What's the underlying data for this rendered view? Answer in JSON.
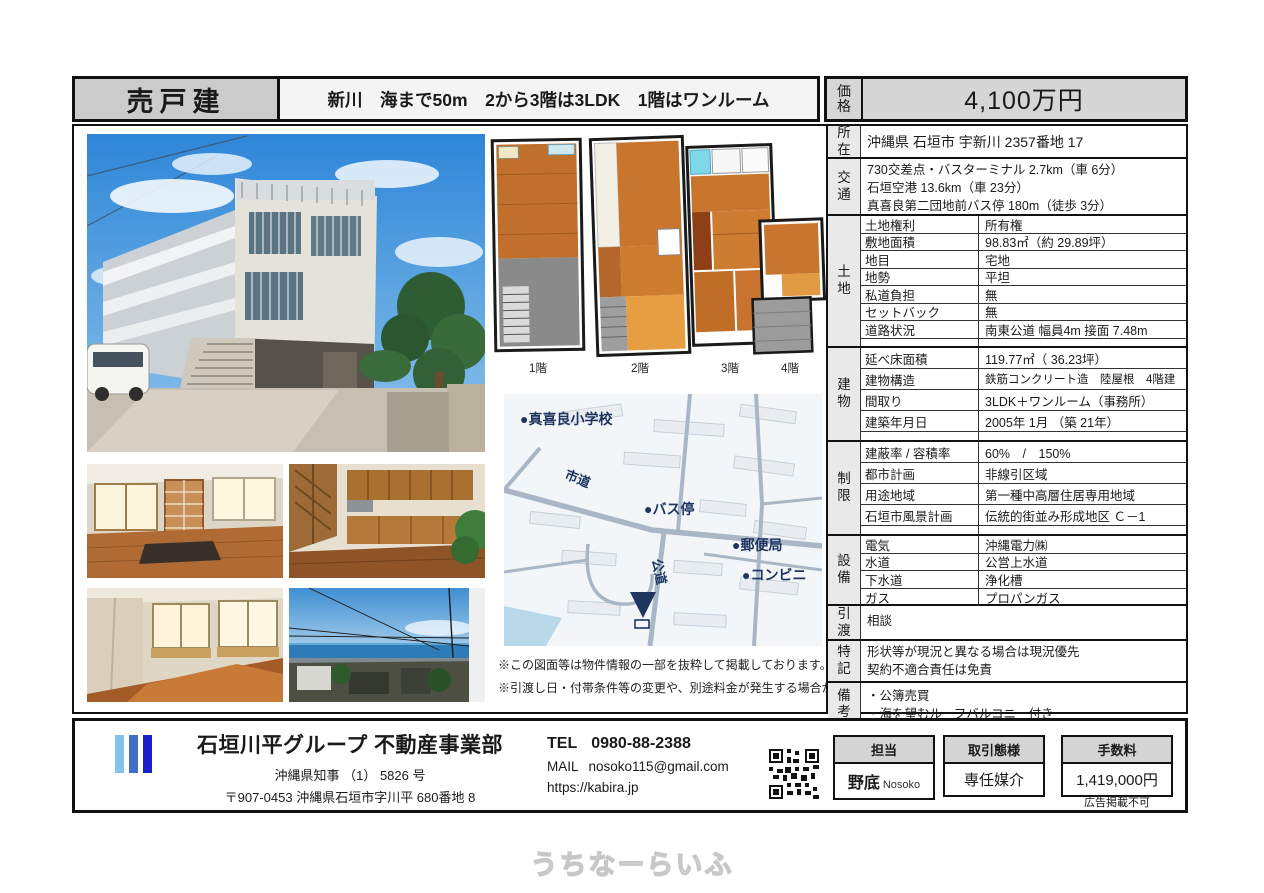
{
  "header": {
    "property_type": "売戸建",
    "subtitle": "新川　海まで50m　2から3階は3LDK　1階はワンルーム",
    "price_label": "価格",
    "price_value": "4,100万円"
  },
  "table": {
    "sections": [
      {
        "label": "所在",
        "value": "沖縄県 石垣市 宇新川 2357番地 17"
      },
      {
        "label": "交通",
        "lines": [
          "730交差点・バスターミナル 2.7km（車 6分）",
          "石垣空港 13.6km（車 23分）",
          "真喜良第二団地前バス停 180m（徒歩 3分）"
        ]
      },
      {
        "label": "土地",
        "rows": [
          {
            "k": "土地権利",
            "v": "所有権"
          },
          {
            "k": "敷地面積",
            "v": "98.83㎡（約 29.89坪）"
          },
          {
            "k": "地目",
            "v": "宅地"
          },
          {
            "k": "地勢",
            "v": "平坦"
          },
          {
            "k": "私道負担",
            "v": "無"
          },
          {
            "k": "セットバック",
            "v": "無"
          },
          {
            "k": "道路状況",
            "v": "南東公道 幅員4m 接面 7.48m"
          }
        ]
      },
      {
        "label": "建物",
        "rows": [
          {
            "k": "延べ床面積",
            "v": "119.77㎡（ 36.23坪）"
          },
          {
            "k": "建物構造",
            "v": "鉄筋コンクリート造　陸屋根　4階建"
          },
          {
            "k": "間取り",
            "v": "3LDK＋ワンルーム（事務所）"
          },
          {
            "k": "建築年月日",
            "v": "2005年 1月 （築 21年）"
          }
        ]
      },
      {
        "label": "制限",
        "rows": [
          {
            "k": "建蔽率 / 容積率",
            "v": "60%　/　150%"
          },
          {
            "k": "都市計画",
            "v": "非線引区域"
          },
          {
            "k": "用途地域",
            "v": "第一種中高層住居専用地域"
          },
          {
            "k": "石垣市風景計画",
            "v": "伝統的街並み形成地区 Ｃ－1"
          }
        ]
      },
      {
        "label": "設備",
        "rows": [
          {
            "k": "電気",
            "v": "沖縄電力㈱"
          },
          {
            "k": "水道",
            "v": "公営上水道"
          },
          {
            "k": "下水道",
            "v": "浄化槽"
          },
          {
            "k": "ガス",
            "v": "プロパンガス"
          }
        ]
      },
      {
        "label": "引渡",
        "value": "相談"
      },
      {
        "label": "特記",
        "lines": [
          "形状等が現況と異なる場合は現況優先",
          "契約不適合責任は免責"
        ]
      },
      {
        "label": "備考",
        "lines": [
          "・公簿売買",
          "・海を望むルーフバルコニー付き"
        ]
      }
    ]
  },
  "plans": {
    "labels": [
      "1階",
      "2階",
      "3階",
      "4階"
    ]
  },
  "map": {
    "school": "●真喜良小学校",
    "shido": "市道",
    "bus_stop": "●バス停",
    "post_office": "●郵便局",
    "convenience": "●コンビニ",
    "kodo": "公道"
  },
  "disclaimers": [
    "※この図面等は物件情報の一部を抜粋して掲載しております。",
    "※引渡し日・付帯条件等の変更や、別途料金が発生する場合がございます。"
  ],
  "footer": {
    "company": "石垣川平グループ 不動産事業部",
    "license": "沖縄県知事 （1） 5826 号",
    "address": "〒907-0453 沖縄県石垣市字川平 680番地 8",
    "tel_label": "TEL",
    "tel": "0980-88-2388",
    "mail_label": "MAIL",
    "mail": "nosoko115@gmail.com",
    "url": "https://kabira.jp",
    "staff_label": "担当",
    "staff_name": "野底",
    "staff_romaji": "Nosoko",
    "deal_label": "取引態様",
    "deal_value": "専任媒介",
    "fee_label": "手数料",
    "fee_value": "1,419,000円",
    "fee_note": "広告掲載不可"
  },
  "watermark": "うちなーらいふ",
  "colors": {
    "accent_navy": "#1e3560",
    "room_orange": "#c8762e",
    "gray_fill": "#d6d6d6"
  }
}
